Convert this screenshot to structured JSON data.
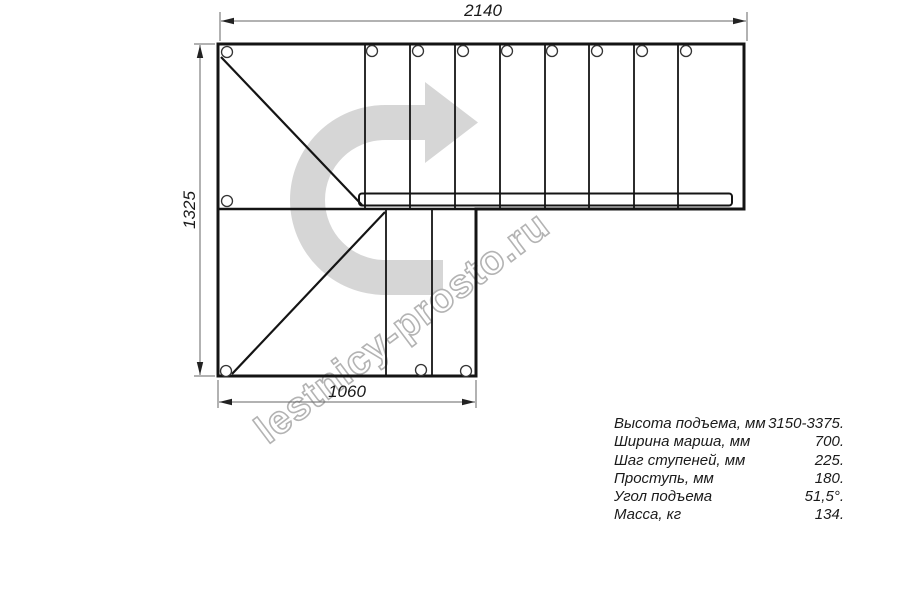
{
  "drawing": {
    "title": "stair-plan-top-view",
    "dimensions": {
      "top_mm": "2140",
      "left_mm": "1325",
      "bottom_mm": "1060"
    },
    "watermark": {
      "text": "lestnicy-prosto.ru",
      "arrow_color": "#d6d6d6",
      "text_outline_color": "#b3b3b3"
    },
    "colors": {
      "line": "#141414",
      "dimension_line": "#666666",
      "dimension_text": "#1a1a1a"
    }
  },
  "specs": {
    "rows": [
      {
        "label": "Высота подъема, мм",
        "value": "3150-3375."
      },
      {
        "label": "Ширина марша, мм",
        "value": "700."
      },
      {
        "label": "Шаг ступеней, мм",
        "value": "225."
      },
      {
        "label": "Проступь, мм",
        "value": "180."
      },
      {
        "label": "Угол подъема",
        "value": "51,5°."
      },
      {
        "label": "Масса, кг",
        "value": "134."
      }
    ]
  }
}
